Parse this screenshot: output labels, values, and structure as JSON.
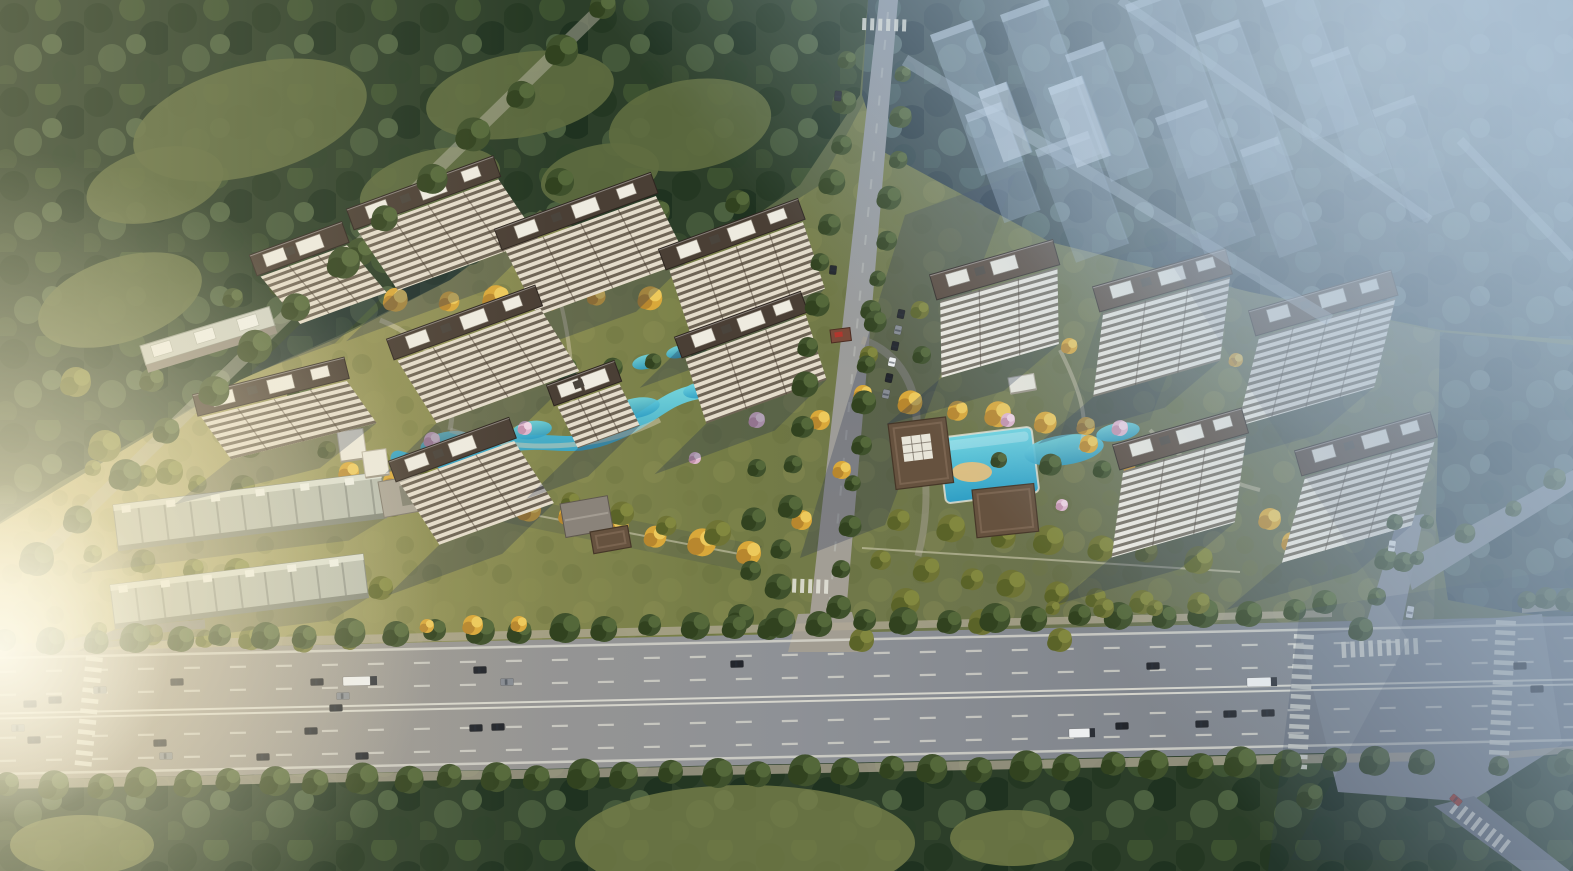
{
  "meta": {
    "w": 1573,
    "h": 871,
    "kind": "aerial-architectural-rendering",
    "subject": "residential-development-masterplan"
  },
  "palette": {
    "forest_dark": "#2c3e29",
    "forest_blue": "#36474b",
    "field_sun": "#c3b679",
    "field_olive": "#747c46",
    "road_warm": "#a59d8e",
    "road_gray": "#8e9196",
    "road_cool": "#717882",
    "lane_white": "#dddcd2",
    "roof_left": "#4a3f35",
    "roof_right": "#564639",
    "roof_brown": "#66523f",
    "facade_cream": "#e4dccb",
    "facade_white": "#f0ece1",
    "water": "#3fb4cf",
    "tree_gold": "#d9a83a",
    "tree_olive": "#6f7435",
    "tree_green": "#3f512c",
    "blossom": "#dfb6cd",
    "haze": "#adc4d9",
    "shadow": "rgba(34,46,76,0.30)",
    "car": {
      "dk": "#23262c",
      "gy": "#878c93",
      "wt": "#edeff0",
      "rd": "#a33b30"
    },
    "tree": {
      "g": [
        "#3f512c",
        "#54683a",
        "#31421f"
      ],
      "o": [
        "#6f7435",
        "#82883f",
        "#5a6328"
      ],
      "y": [
        "#d9a83a",
        "#edc95b",
        "#b8872e"
      ],
      "b": [
        "#dfb6cd",
        "#efd3e2",
        "#c493ad"
      ]
    }
  },
  "scene": {
    "field": "0,652 0,524 150,434 240,380 340,337 450,280 540,214 620,252 730,242 820,185 865,100 880,150 1050,242 1250,292 1440,332 1434,620 1460,640 1460,652",
    "forest_tl": "0,0 868,0 860,95 800,185 720,240 620,250 540,210 450,280 340,335 240,380 150,432 60,482 0,522",
    "forest_tr": "868,0 1573,0 1573,340 1440,330 1250,292 1050,242 880,150 862,95",
    "forest_re": "1440,332 1573,345 1573,620 1500,610 1448,600 1436,520",
    "forest_b": "0,775 400,768 800,760 1200,752 1573,745 1573,871 0,871",
    "meadows_tl": [
      [
        250,
        120,
        120,
        55,
        -15
      ],
      [
        520,
        95,
        95,
        42,
        -10
      ],
      [
        120,
        300,
        85,
        42,
        -18
      ],
      [
        430,
        185,
        72,
        34,
        -15
      ],
      [
        690,
        125,
        82,
        45,
        -10
      ],
      [
        600,
        175,
        60,
        30,
        -12
      ],
      [
        155,
        185,
        70,
        36,
        -14
      ]
    ],
    "meadows_b": [
      [
        745,
        843,
        170,
        58,
        0
      ],
      [
        1012,
        838,
        62,
        28,
        0
      ],
      [
        82,
        845,
        72,
        30,
        0
      ]
    ],
    "roads": {
      "highway": "0,652 1573,616 1573,748 0,780",
      "intersection": "1300,636 1542,614 1562,744 1470,802 1338,792",
      "central": "879,0 898,0 843,650 806,650",
      "apron": "798,614 852,612 862,652 788,652",
      "right": "1398,518 1424,514 1398,644 1360,644",
      "branch": "1404,562 1573,470 1573,490 1412,590",
      "continuation": "1434,806 1474,796 1570,871 1522,871",
      "sidewalks": [
        "0,644 1332,610 1332,617 0,653",
        "1522,606 1573,602 1573,609 1522,613",
        "0,780 1432,752 1432,761 0,789",
        "1500,752 1573,746 1573,753 1500,759"
      ],
      "forest_edge_road": [
        606,
        4,
        34,
        562,
        13
      ],
      "service": [
        {
          "d": "M 40,652 C 96,636 150,628 205,624",
          "w": 9,
          "o": 0.8
        },
        {
          "d": "M 862,340 C 900,352 920,390 916,430",
          "w": 8,
          "o": 0.55
        },
        {
          "d": "M 916,430 C 930,470 928,520 918,556",
          "w": 7,
          "o": 0.5
        }
      ]
    },
    "markings": {
      "mid": [
        0,
        716,
        1573,
        682
      ],
      "median": [
        -2.5,
        2.5
      ],
      "dashes": [
        -44,
        -21,
        22,
        45
      ],
      "edges": [
        -58,
        58
      ],
      "central_dash": [
        888,
        12,
        826,
        640
      ]
    },
    "crosswalks": [
      [
        1294,
        634,
        3,
        14,
        10,
        20,
        4.5
      ],
      [
        1496,
        620,
        3,
        14,
        10,
        20,
        4.5
      ],
      [
        1342,
        658,
        -93,
        9,
        9,
        16,
        4.5
      ],
      [
        1449,
        812,
        -52,
        8,
        9,
        15,
        4
      ],
      [
        86,
        656,
        6,
        11,
        10.5,
        17,
        4.5
      ],
      [
        776,
        592,
        -88,
        7,
        8,
        14,
        4
      ],
      [
        862,
        30,
        -88,
        6,
        8,
        12,
        4
      ]
    ],
    "shadows_ground": [
      [
        "905,215 1015,175 885,525 800,558",
        0.28
      ],
      [
        "1120,255 1225,225 1150,420 1055,452",
        0.18
      ],
      [
        "380,470 762,546 748,572 366,494",
        0.16
      ]
    ],
    "shadows_over": [
      [
        "1150,230 1400,180 1573,420 1573,860 1290,860 1408,640",
        0.13
      ],
      [
        "1300,610 1573,568 1573,871 1268,871",
        0.2
      ]
    ],
    "water": {
      "river": "M398,458 C 440,472 475,448 512,444 C 556,438 572,452 614,434 C 652,418 664,398 696,392 C 712,389 724,396 736,398",
      "blobs": [
        [
          446,
          443,
          26,
          11,
          -12
        ],
        [
          532,
          430,
          20,
          9,
          -8
        ],
        [
          636,
          408,
          24,
          10,
          -10
        ],
        [
          700,
          390,
          17,
          8,
          -10
        ],
        [
          646,
          362,
          14,
          7,
          -14
        ],
        [
          678,
          352,
          12,
          6,
          -14
        ]
      ],
      "pool": [
        938,
        438,
        94,
        66,
        -7
      ],
      "sand": [
        972,
        472,
        20,
        10
      ],
      "ponds": [
        [
          1064,
          450,
          40,
          15,
          -8
        ],
        [
          1118,
          432,
          22,
          9,
          -10
        ],
        [
          1152,
          446,
          14,
          6,
          -8
        ]
      ]
    },
    "paths": [
      {
        "d": "M 380,320 C 430,340 460,380 450,430",
        "w": 5,
        "o": 0.5
      },
      {
        "d": "M 450,430 C 520,455 600,450 660,420",
        "w": 5,
        "o": 0.5
      },
      {
        "d": "M 560,300 C 570,340 575,380 570,420",
        "w": 4,
        "o": 0.45
      },
      {
        "d": "M 1060,350 C 1080,390 1090,420 1080,450",
        "w": 4,
        "o": 0.45
      },
      {
        "d": "M 1150,430 C 1180,460 1220,480 1260,490",
        "w": 4,
        "o": 0.45
      }
    ],
    "walls": [
      {
        "d": "M340,478 L750,556",
        "w": 2,
        "o": 0.5
      },
      {
        "d": "M862,548 L1240,572",
        "w": 2,
        "o": 0.5
      }
    ],
    "belts_garden": [
      [
        345,
        300,
        700,
        298,
        8,
        11,
        "y"
      ],
      [
        352,
        474,
        746,
        552,
        10,
        12,
        "y"
      ],
      [
        330,
        452,
        718,
        534,
        9,
        11,
        "o"
      ],
      [
        866,
        396,
        1088,
        428,
        6,
        11,
        "y"
      ],
      [
        1092,
        446,
        1268,
        518,
        5,
        11,
        "y"
      ],
      [
        902,
        522,
        1198,
        560,
        7,
        13,
        "o"
      ],
      [
        96,
        470,
        392,
        506,
        7,
        10,
        "o"
      ],
      [
        96,
        556,
        380,
        588,
        7,
        11,
        "o"
      ],
      [
        102,
        632,
        352,
        644,
        6,
        10,
        "o"
      ],
      [
        432,
        380,
        700,
        360,
        7,
        10,
        "g"
      ],
      [
        1002,
        462,
        1148,
        470,
        4,
        10,
        "g"
      ],
      [
        952,
        332,
        1238,
        362,
        6,
        9,
        "y"
      ],
      [
        884,
        562,
        1098,
        600,
        6,
        12,
        "o"
      ],
      [
        236,
        300,
        330,
        268,
        3,
        12,
        "g"
      ],
      [
        760,
        470,
        742,
        618,
        4,
        11,
        "g"
      ]
    ],
    "belts_road": [
      [
        850,
        62,
        772,
        628,
        15,
        11,
        "g"
      ],
      [
        906,
        76,
        838,
        608,
        14,
        10,
        "g"
      ],
      [
        8,
        642,
        1292,
        612,
        31,
        13,
        "g"
      ],
      [
        1530,
        602,
        1568,
        600,
        2,
        11,
        "g"
      ],
      [
        10,
        786,
        1420,
        760,
        33,
        14,
        "g"
      ],
      [
        1502,
        768,
        1568,
        762,
        2,
        12,
        "g"
      ],
      [
        1398,
        524,
        1362,
        630,
        4,
        10,
        "g"
      ],
      [
        1430,
        524,
        1404,
        562,
        2,
        9,
        "g"
      ],
      [
        606,
        8,
        36,
        560,
        14,
        15,
        "g"
      ],
      [
        430,
        628,
        516,
        622,
        3,
        9,
        "y"
      ],
      [
        1056,
        610,
        1200,
        604,
        4,
        9,
        "o"
      ],
      [
        1420,
        560,
        1556,
        480,
        4,
        9,
        "g"
      ]
    ],
    "clumps": [
      [
        105,
        446,
        16,
        "o"
      ],
      [
        170,
        472,
        13,
        "o"
      ],
      [
        250,
        446,
        12,
        "o"
      ],
      [
        76,
        382,
        15,
        "o"
      ],
      [
        152,
        380,
        12,
        "g"
      ],
      [
        300,
        392,
        12,
        "g"
      ],
      [
        360,
        252,
        14,
        "g"
      ],
      [
        470,
        252,
        13,
        "g"
      ],
      [
        302,
        282,
        12,
        "g"
      ],
      [
        658,
        212,
        12,
        "g"
      ],
      [
        738,
        202,
        12,
        "g"
      ],
      [
        560,
        182,
        14,
        "g"
      ],
      [
        906,
        602,
        14,
        "o"
      ],
      [
        982,
        622,
        13,
        "o"
      ],
      [
        1060,
        640,
        12,
        "o"
      ],
      [
        862,
        640,
        12,
        "o"
      ],
      [
        1142,
        602,
        12,
        "o"
      ],
      [
        1325,
        602,
        12,
        "g"
      ],
      [
        1546,
        598,
        11,
        "g"
      ],
      [
        1310,
        796,
        13,
        "g"
      ],
      [
        820,
        420,
        10,
        "y"
      ],
      [
        842,
        470,
        9,
        "y"
      ],
      [
        802,
        520,
        10,
        "y"
      ],
      [
        1292,
        542,
        10,
        "y"
      ],
      [
        871,
        310,
        10,
        "g"
      ],
      [
        922,
        355,
        9,
        "g"
      ],
      [
        869,
        355,
        9,
        "o"
      ],
      [
        920,
        310,
        9,
        "o"
      ]
    ],
    "blossoms": [
      [
        432,
        440,
        8
      ],
      [
        525,
        428,
        7
      ],
      [
        610,
        408,
        7
      ],
      [
        757,
        420,
        8
      ],
      [
        695,
        458,
        6
      ],
      [
        910,
        432,
        7
      ],
      [
        1008,
        420,
        7
      ],
      [
        1120,
        428,
        8
      ],
      [
        1062,
        505,
        6
      ],
      [
        1228,
        480,
        6
      ]
    ],
    "towers_left": [
      [
        253,
        256,
        92,
        58
      ],
      [
        350,
        210,
        150,
        70
      ],
      [
        498,
        230,
        160,
        72
      ],
      [
        662,
        250,
        142,
        70
      ],
      [
        390,
        340,
        152,
        72
      ],
      [
        678,
        338,
        128,
        68
      ],
      [
        196,
        396,
        150,
        48,
        -14
      ],
      [
        392,
        462,
        122,
        72
      ],
      [
        550,
        386,
        66,
        46
      ]
    ],
    "slabs_light": [
      [
        140,
        346,
        135,
        -17
      ]
    ],
    "towers_right": [
      [
        933,
        276,
        122,
        74
      ],
      [
        1096,
        288,
        132,
        78
      ],
      [
        1252,
        312,
        142,
        80
      ],
      [
        1116,
        446,
        128,
        80
      ],
      [
        1298,
        452,
        135,
        76
      ]
    ],
    "rows": [
      [
        113,
        505,
        270,
        46,
        -7
      ],
      [
        110,
        585,
        255,
        44,
        -7
      ]
    ],
    "pavilions": [
      [
        888,
        424,
        58,
        66,
        -7,
        "club"
      ],
      [
        972,
        490,
        62,
        48,
        -6,
        "brown"
      ],
      [
        830,
        330,
        20,
        13,
        -7,
        "gate"
      ],
      [
        337,
        432,
        26,
        30,
        -8,
        "white"
      ],
      [
        362,
        452,
        24,
        26,
        -8,
        "white"
      ],
      [
        468,
        464,
        22,
        20,
        -8,
        "white"
      ],
      [
        560,
        504,
        48,
        34,
        -10,
        "gray"
      ],
      [
        590,
        532,
        38,
        22,
        -10,
        "brown"
      ],
      [
        378,
        482,
        92,
        36,
        -10,
        "graylow"
      ],
      [
        1008,
        378,
        26,
        16,
        -10,
        "white"
      ]
    ],
    "ghosts": [
      [
        930,
        35,
        44,
        150,
        0.42,
        0
      ],
      [
        1000,
        15,
        50,
        165,
        0.38,
        0
      ],
      [
        1065,
        55,
        40,
        135,
        0.42,
        0
      ],
      [
        1125,
        5,
        52,
        185,
        0.34,
        0
      ],
      [
        1195,
        35,
        46,
        160,
        0.36,
        0
      ],
      [
        1262,
        0,
        48,
        150,
        0.32,
        0
      ],
      [
        1035,
        150,
        56,
        120,
        0.3,
        0
      ],
      [
        1155,
        118,
        54,
        145,
        0.3,
        0
      ],
      [
        1240,
        150,
        40,
        115,
        0.28,
        0
      ],
      [
        965,
        115,
        38,
        115,
        0.36,
        0
      ],
      [
        1310,
        60,
        40,
        130,
        0.26,
        0
      ],
      [
        1372,
        110,
        44,
        120,
        0.22,
        0
      ],
      [
        1048,
        88,
        36,
        85,
        0.6,
        1
      ],
      [
        978,
        92,
        30,
        75,
        0.55,
        1
      ]
    ],
    "haze_roads": [
      [
        905,
        60,
        1330,
        320,
        12
      ],
      [
        1120,
        0,
        1430,
        220,
        9
      ],
      [
        1460,
        140,
        1573,
        258,
        9
      ]
    ],
    "cars": [
      {
        "x": 55,
        "y": 700
      },
      {
        "x": 30,
        "y": 704
      },
      {
        "x": 18,
        "y": 728,
        "c": "gy"
      },
      {
        "x": 34,
        "y": 740
      },
      {
        "x": 100,
        "y": 690,
        "c": "gy"
      },
      {
        "x": 177,
        "y": 682
      },
      {
        "x": 160,
        "y": 743
      },
      {
        "x": 166,
        "y": 756,
        "c": "gy"
      },
      {
        "x": 263,
        "y": 757
      },
      {
        "x": 317,
        "y": 682
      },
      {
        "x": 343,
        "y": 696,
        "c": "gy"
      },
      {
        "x": 336,
        "y": 708
      },
      {
        "x": 311,
        "y": 731
      },
      {
        "x": 362,
        "y": 756
      },
      {
        "x": 480,
        "y": 670
      },
      {
        "x": 507,
        "y": 682,
        "c": "gy"
      },
      {
        "x": 476,
        "y": 728
      },
      {
        "x": 498,
        "y": 727
      },
      {
        "x": 737,
        "y": 664
      },
      {
        "x": 1153,
        "y": 666
      },
      {
        "x": 1122,
        "y": 726
      },
      {
        "x": 1202,
        "y": 724
      },
      {
        "x": 1230,
        "y": 714
      },
      {
        "x": 1268,
        "y": 713
      },
      {
        "x": 1520,
        "y": 666
      },
      {
        "x": 1537,
        "y": 689
      },
      {
        "x": 360,
        "y": 681,
        "c": "wt",
        "l": 34,
        "t": 1
      },
      {
        "x": 1262,
        "y": 682,
        "c": "wt",
        "l": 30,
        "t": 1
      },
      {
        "x": 1082,
        "y": 733,
        "c": "wt",
        "l": 26,
        "t": 1
      },
      {
        "x": 1410,
        "y": 612,
        "c": "wt",
        "a": -80,
        "l": 12
      },
      {
        "x": 1392,
        "y": 546,
        "c": "wt",
        "a": -82,
        "l": 11
      },
      {
        "x": 1456,
        "y": 800,
        "c": "rd",
        "a": 40,
        "l": 12
      },
      {
        "x": 838,
        "y": 96,
        "a": -84,
        "l": 10
      },
      {
        "x": 833,
        "y": 270,
        "a": -84,
        "l": 9
      },
      {
        "x": 901,
        "y": 314,
        "a": -78,
        "l": 9
      },
      {
        "x": 898,
        "y": 330,
        "a": -78,
        "l": 9,
        "c": "gy"
      },
      {
        "x": 895,
        "y": 346,
        "a": -78,
        "l": 9
      },
      {
        "x": 892,
        "y": 362,
        "a": -78,
        "l": 9,
        "c": "wt"
      },
      {
        "x": 889,
        "y": 378,
        "a": -78,
        "l": 9
      },
      {
        "x": 886,
        "y": 394,
        "a": -78,
        "l": 9,
        "c": "gy"
      }
    ]
  }
}
